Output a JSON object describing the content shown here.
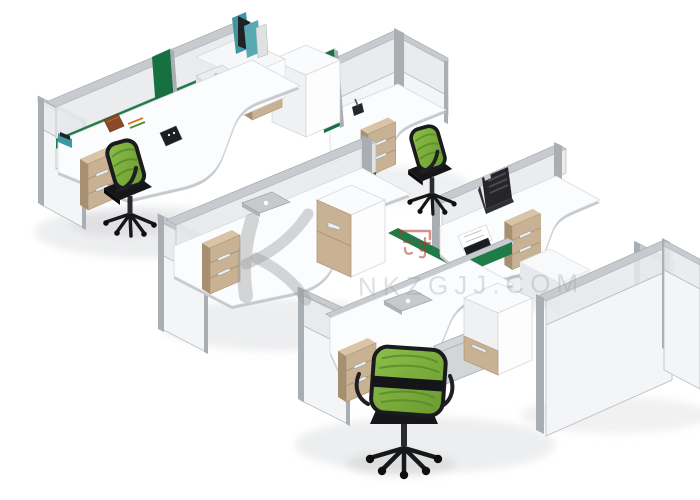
{
  "meta": {
    "description": "Isometric 3D product photograph of staggered modular office cubicle workstations: white L-shaped desks, aluminium-framed partitions with frosted glass tops and green fabric screens, beige drawer pedestals, white storage cubes and green mesh office chairs on a pure white studio background.",
    "background_color": "#ffffff"
  },
  "watermark": {
    "text": "NKZGJJ.COM",
    "logo_icon": "swoosh-k-logo",
    "stamp_icon": "crown-character-stamp",
    "stamp_char": "冠",
    "text_color": "#9ba0a4",
    "stamp_color": "#b2392e"
  },
  "colors": {
    "background": "#ffffff",
    "frame": "#a9aeb3",
    "rail": "#c7cbcf",
    "panel_white": "#f4f5f6",
    "glass": "#e7eaec",
    "panel_border": "#b7bcc0",
    "screen_green": "#1f7b48",
    "divider_green": "#17703f",
    "desk_top": "#fbfcfd",
    "desk_edge": "#c6cacd",
    "cabinet_beige": "#c9b294",
    "cabinet_beige_side": "#a78f72",
    "cabinet_beige_line": "#a98f6f",
    "cabinet_white": "#f7f8fa",
    "chair_mesh": "#7fb23f",
    "chair_mesh_dark": "#5a8b2a",
    "chair_black": "#17181a",
    "laptop_gray": "#c6cacd",
    "laptop_white": "#ebedee",
    "file_teal": "#3e97a1",
    "shadow": "#dcdddf"
  },
  "scene": {
    "units": [
      {
        "id": "workstation-1",
        "position": "top-left",
        "furniture": [
          "l-shaped-desk",
          "green-mesh-chair",
          "beige-3-drawer-pedestal",
          "partition-screen-left",
          "partition-screen-back",
          "green-divider-panel",
          "white-storage-cube",
          "beige-cabinet",
          "teal-file-holder",
          "white-laptop",
          "brown-notebook",
          "pens",
          "black-desk-clock"
        ]
      },
      {
        "id": "workstation-2",
        "position": "upper-middle",
        "furniture": [
          "corner-partition",
          "l-shaped-desk",
          "beige-pedestal",
          "black-pen-cup",
          "documents",
          "green-divider-panel"
        ]
      },
      {
        "id": "workstation-3",
        "position": "center",
        "furniture": [
          "l-shaped-desk",
          "partition-screen-left",
          "partition-screen-back",
          "green-screen-strip",
          "gray-laptop",
          "beige-3-drawer-pedestal",
          "storage-cube-beige-side"
        ]
      },
      {
        "id": "workstation-4",
        "position": "middle-right",
        "furniture": [
          "l-shaped-desk",
          "low-back-partition",
          "green-mesh-chair",
          "black-file-rack",
          "documents",
          "black-notebook",
          "beige-cabinet",
          "white-return-desk",
          "end-partition",
          "green-cross-screen"
        ]
      },
      {
        "id": "workstation-5",
        "position": "bottom",
        "furniture": [
          "l-shaped-desk",
          "partition-screen-left",
          "green-screen-strip",
          "gray-laptop",
          "keyboard-tray",
          "beige-3-drawer-pedestal",
          "white-storage-cube",
          "green-mesh-chair-back-view"
        ]
      }
    ],
    "enclosure": [
      "right-partition-wall-long",
      "right-partition-wall-short"
    ]
  }
}
